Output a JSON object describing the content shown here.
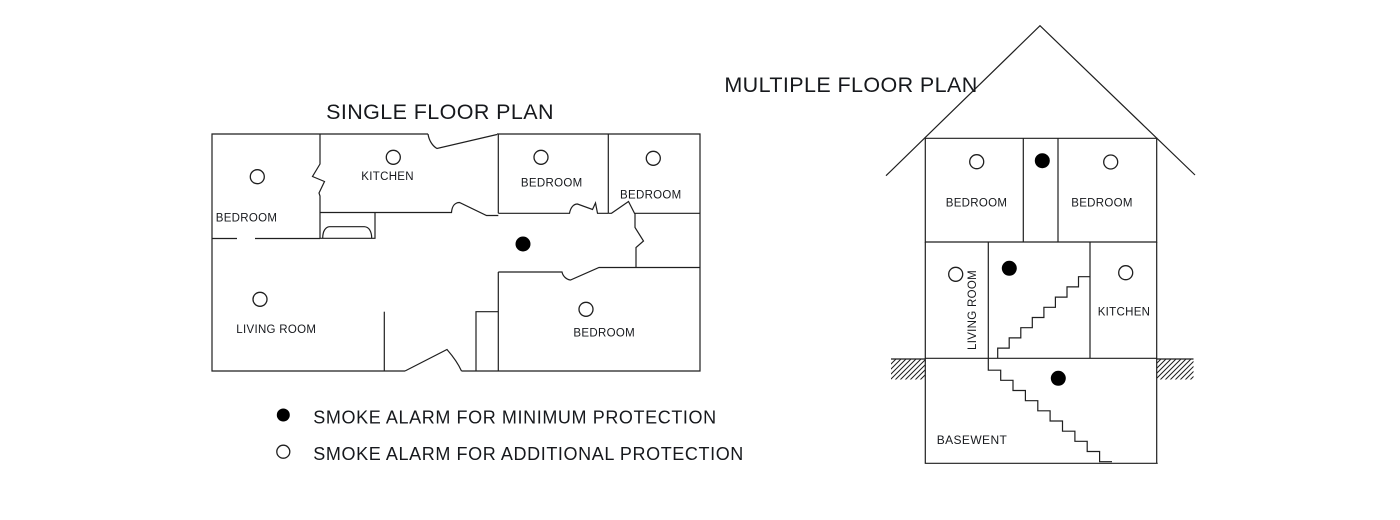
{
  "single_floor": {
    "title": "SINGLE FLOOR PLAN",
    "rooms": [
      {
        "label": "BEDROOM"
      },
      {
        "label": "KITCHEN"
      },
      {
        "label": "BEDROOM"
      },
      {
        "label": "BEDROOM"
      },
      {
        "label": "LIVING ROOM"
      },
      {
        "label": "BEDROOM"
      }
    ],
    "alarm_markers": [
      {
        "type": "minimum",
        "location": "hallway"
      },
      {
        "type": "additional",
        "location": "bedroom-top-left"
      },
      {
        "type": "additional",
        "location": "kitchen"
      },
      {
        "type": "additional",
        "location": "bedroom-top-middle"
      },
      {
        "type": "additional",
        "location": "bedroom-top-right"
      },
      {
        "type": "additional",
        "location": "living-room"
      },
      {
        "type": "additional",
        "location": "bedroom-bottom"
      }
    ]
  },
  "multiple_floor": {
    "title": "MULTIPLE FLOOR PLAN",
    "floors": {
      "top": {
        "rooms": [
          {
            "label": "BEDROOM"
          },
          {
            "label": "BEDROOM"
          }
        ],
        "alarm_markers": [
          {
            "type": "additional",
            "location": "bedroom-left"
          },
          {
            "type": "minimum",
            "location": "hallway"
          },
          {
            "type": "additional",
            "location": "bedroom-right"
          }
        ]
      },
      "middle": {
        "rooms": [
          {
            "label": "LIVING ROOM"
          },
          {
            "label": "KITCHEN"
          }
        ],
        "alarm_markers": [
          {
            "type": "additional",
            "location": "living-room"
          },
          {
            "type": "minimum",
            "location": "stairwell"
          },
          {
            "type": "additional",
            "location": "kitchen"
          }
        ]
      },
      "basement": {
        "label": "BASEWENT",
        "alarm_markers": [
          {
            "type": "minimum",
            "location": "basement"
          }
        ]
      }
    }
  },
  "legend": {
    "items": [
      {
        "symbol": "filled-circle",
        "label": "SMOKE ALARM FOR MINIMUM PROTECTION"
      },
      {
        "symbol": "open-circle",
        "label": "SMOKE ALARM FOR ADDITIONAL PROTECTION"
      }
    ]
  },
  "colors": {
    "line": "#1f1f1f",
    "text": "#16181c",
    "background": "#ffffff"
  }
}
